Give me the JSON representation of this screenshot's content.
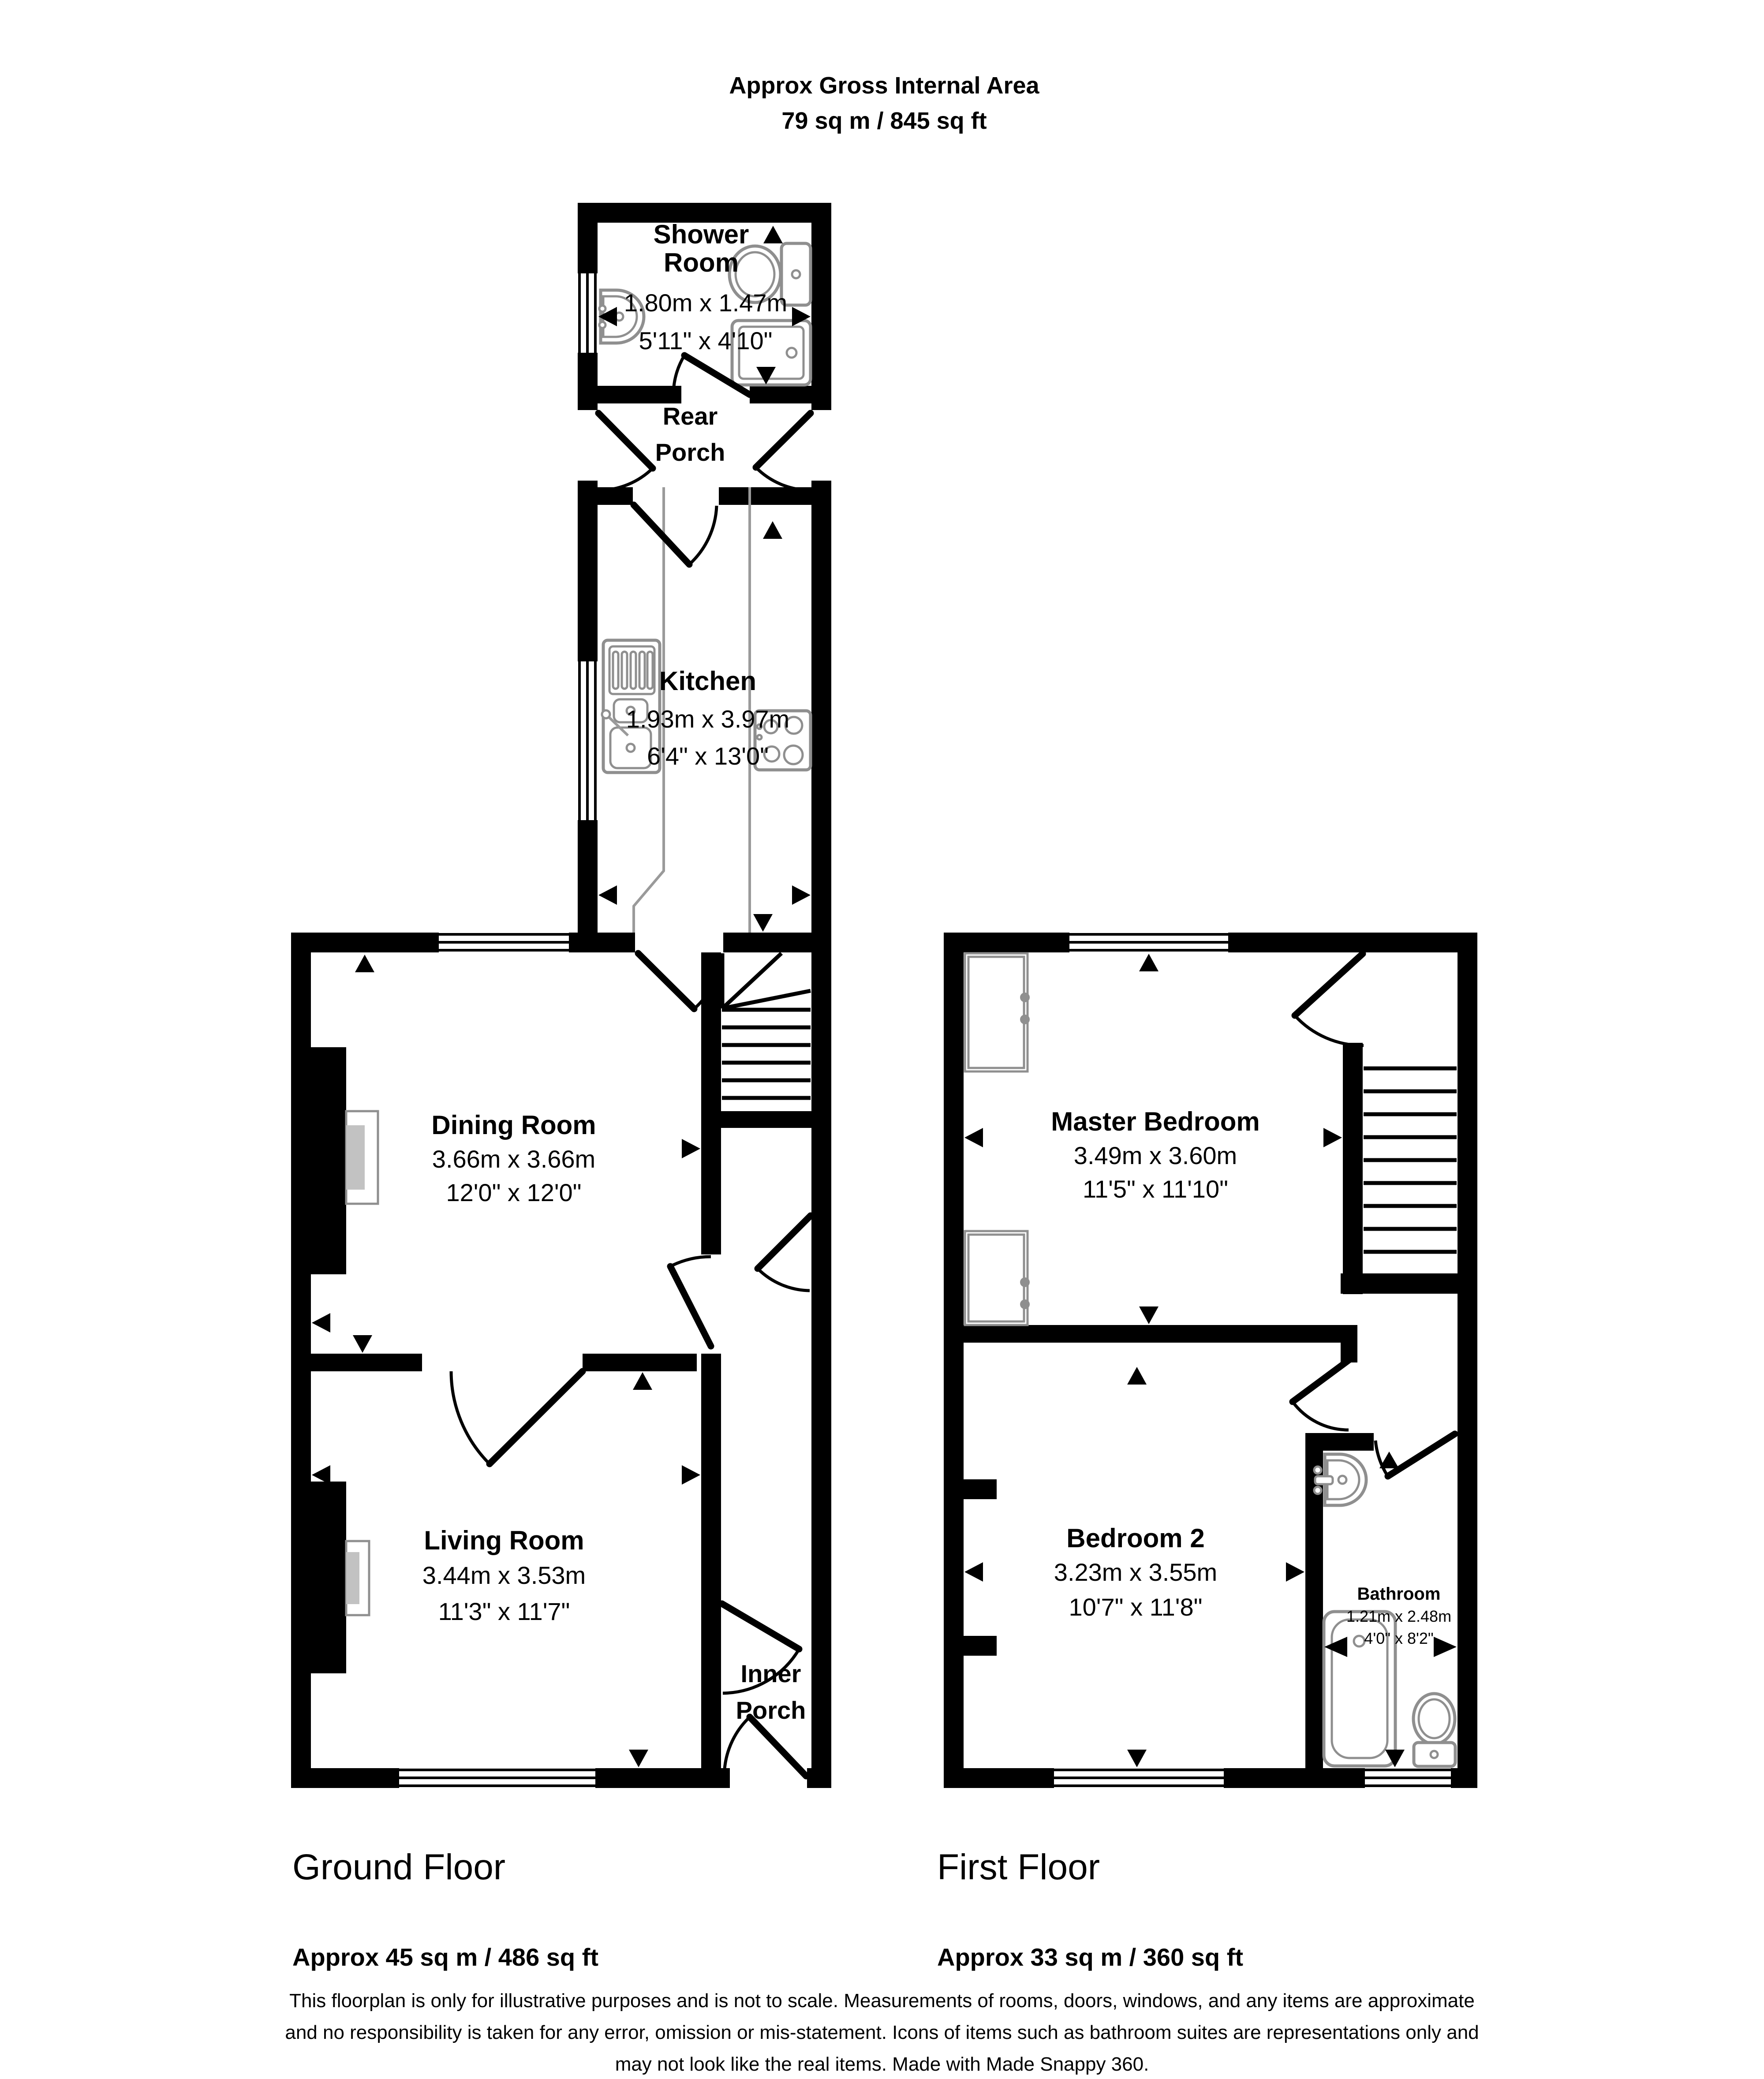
{
  "title": {
    "line1": "Approx Gross Internal Area",
    "line2": "79 sq m / 845 sq ft"
  },
  "rooms": {
    "shower_room": {
      "name_line1": "Shower",
      "name_line2": "Room",
      "metric": "1.80m x 1.47m",
      "imperial": "5'11\" x 4'10\""
    },
    "rear_porch": {
      "name_line1": "Rear",
      "name_line2": "Porch"
    },
    "kitchen": {
      "name": "Kitchen",
      "metric": "1.93m x 3.97m",
      "imperial": "6'4\" x 13'0\""
    },
    "dining_room": {
      "name": "Dining Room",
      "metric": "3.66m x 3.66m",
      "imperial": "12'0\" x 12'0\""
    },
    "living_room": {
      "name": "Living Room",
      "metric": "3.44m x 3.53m",
      "imperial": "11'3\" x 11'7\""
    },
    "inner_porch": {
      "name_line1": "Inner",
      "name_line2": "Porch"
    },
    "master_bedroom": {
      "name": "Master Bedroom",
      "metric": "3.49m x 3.60m",
      "imperial": "11'5\" x 11'10\""
    },
    "bedroom_2": {
      "name": "Bedroom 2",
      "metric": "3.23m x 3.55m",
      "imperial": "10'7\" x 11'8\""
    },
    "bathroom": {
      "name": "Bathroom",
      "metric": "1.21m x 2.48m",
      "imperial": "4'0\" x 8'2\""
    }
  },
  "floors": {
    "ground": {
      "name": "Ground Floor",
      "area": "Approx 45 sq m / 486 sq ft"
    },
    "first": {
      "name": "First Floor",
      "area": "Approx 33 sq m / 360 sq ft"
    }
  },
  "disclaimer": {
    "line1": "This floorplan is only for illustrative purposes and is not to scale. Measurements of rooms, doors, windows, and any items are approximate",
    "line2": "and no responsibility is taken for any error, omission or mis-statement. Icons of items such as bathroom suites are representations only and",
    "line3": "may not look like the real items. Made with Made Snappy 360."
  },
  "colors": {
    "wall": "#000000",
    "fixture_outline": "#8f8f8f",
    "counter_outline": "#9a9a9a",
    "fireplace_fill": "#c2c2c2",
    "text": "#000000",
    "background": "#ffffff"
  },
  "icons": [
    "toilet-icon",
    "hand-basin-icon",
    "shower-tray-icon",
    "kitchen-sink-icon",
    "hob-icon",
    "bath-icon",
    "stairs-icon",
    "door-swing-icon",
    "window-icon",
    "fireplace-icon",
    "wardrobe-icon",
    "measurement-arrow-icon"
  ]
}
